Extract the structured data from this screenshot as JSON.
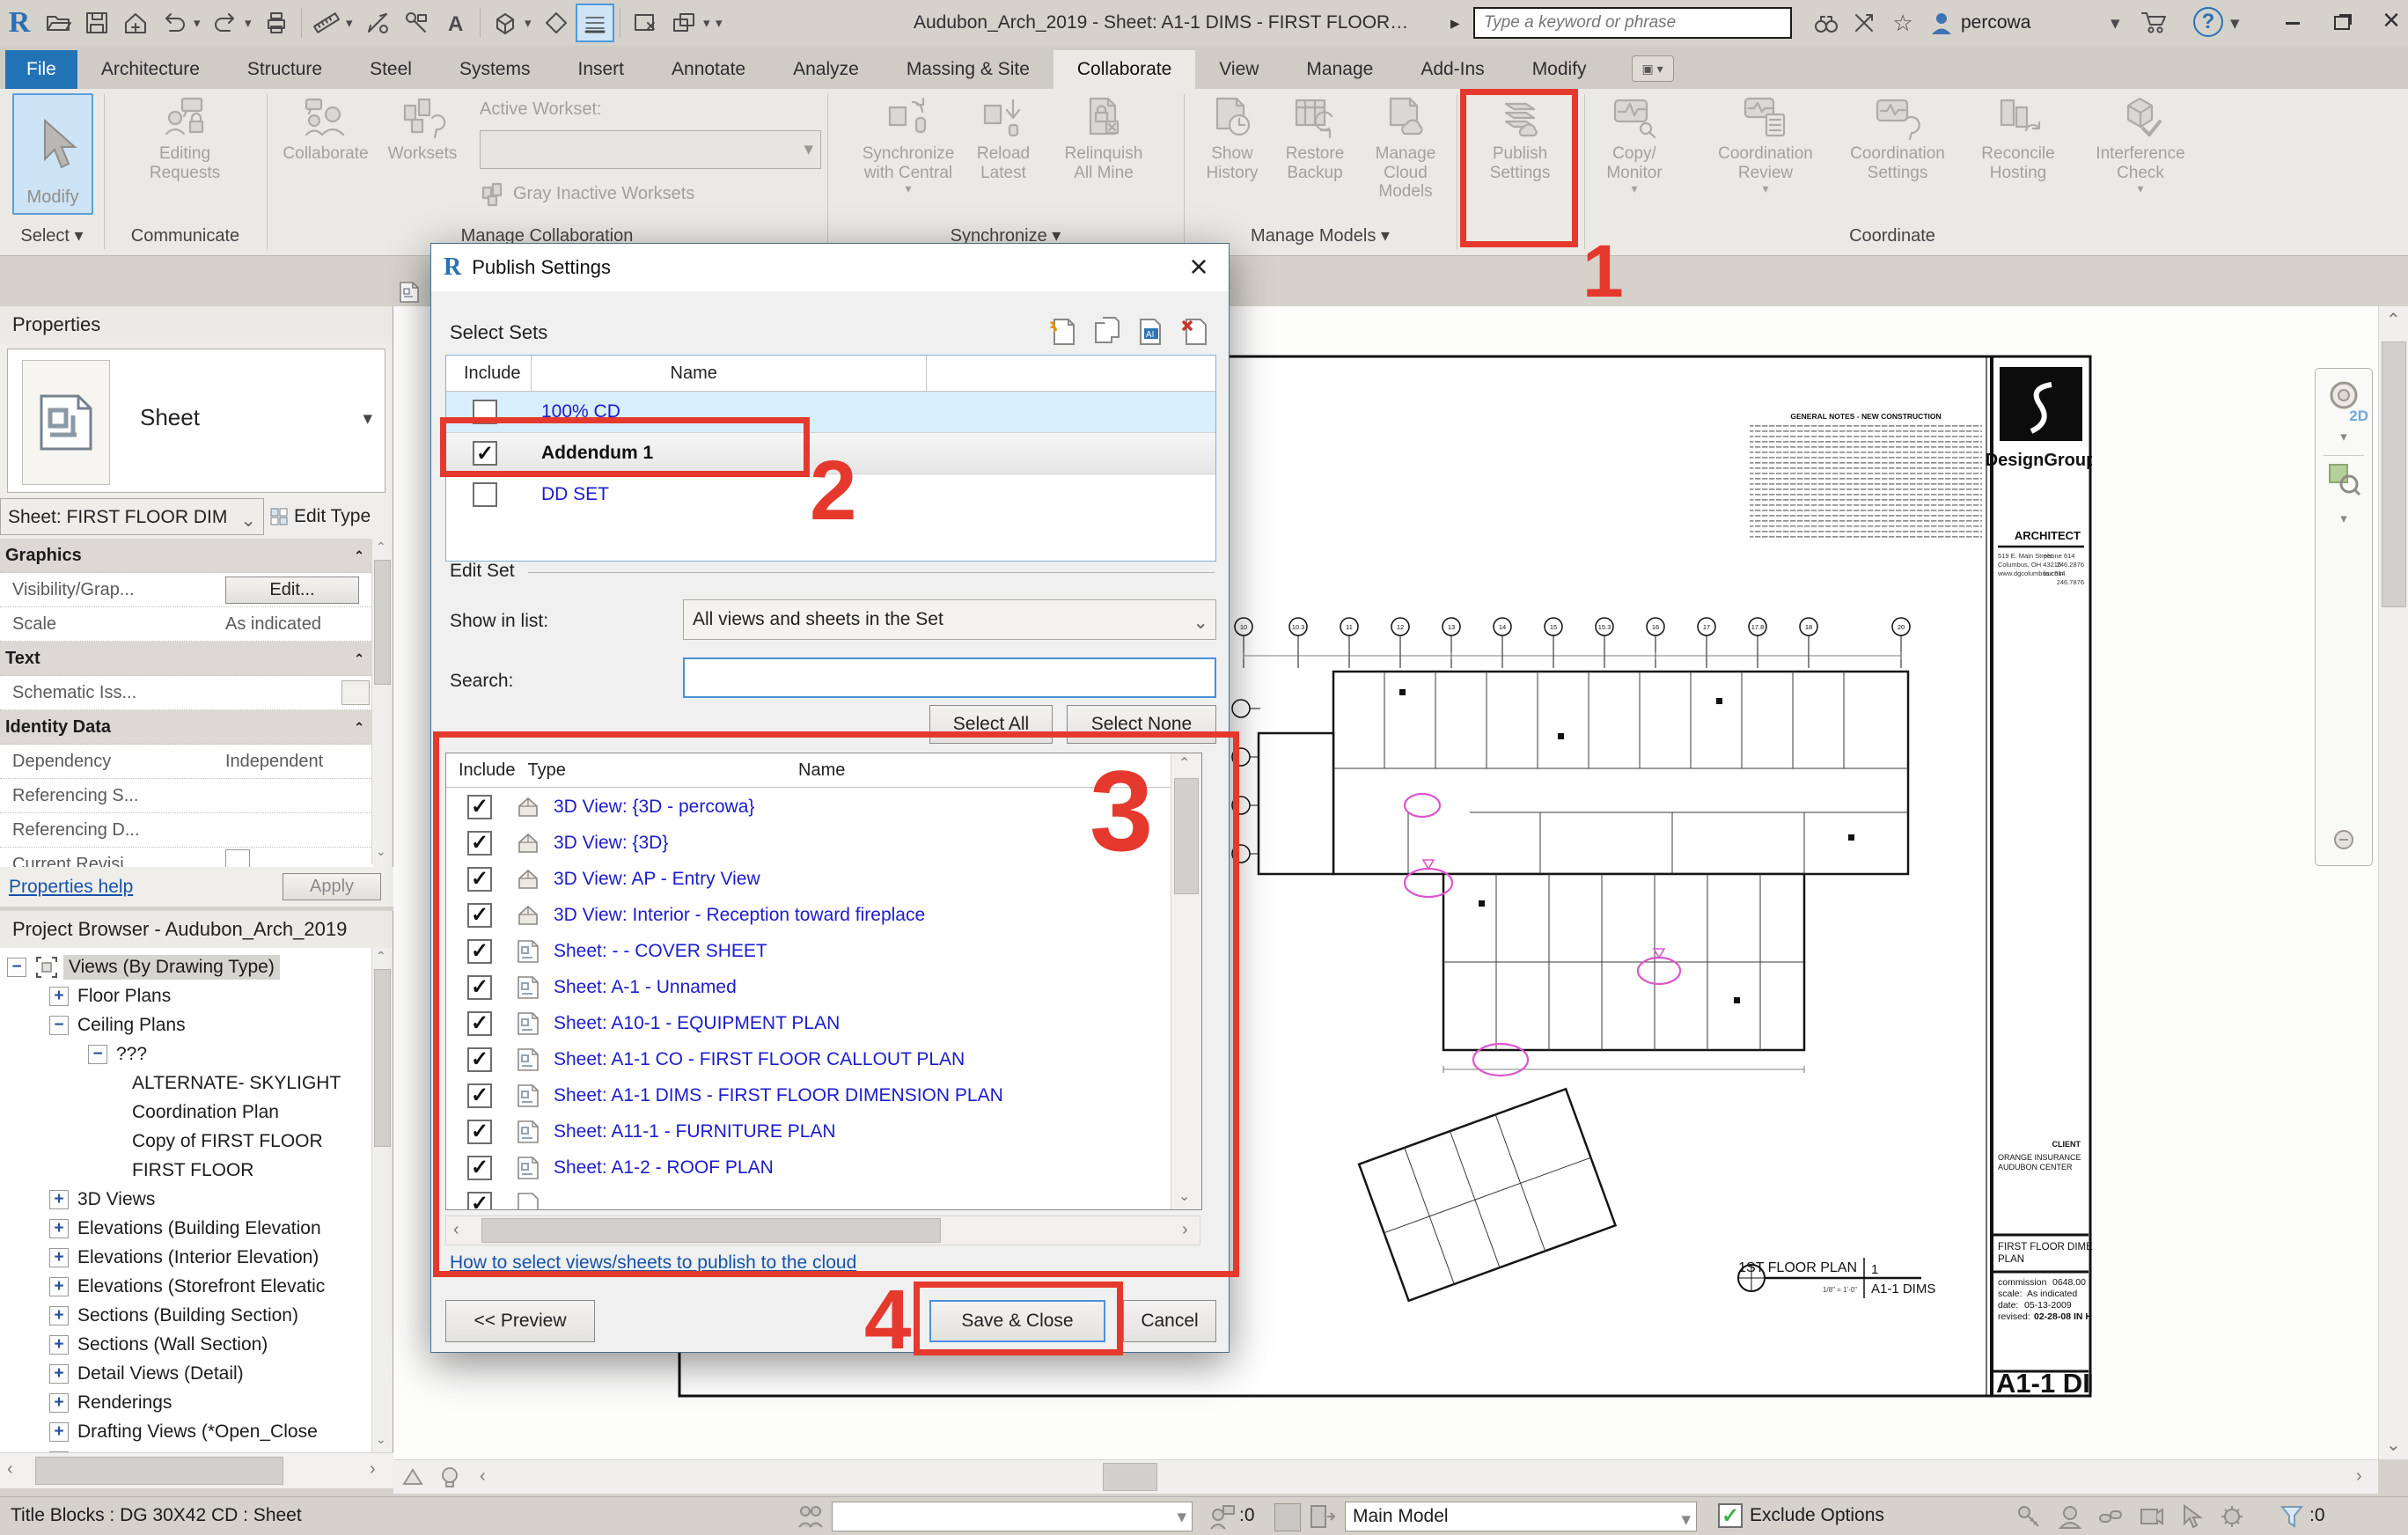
{
  "title_bar": {
    "title": "Audubon_Arch_2019 - Sheet: A1-1 DIMS - FIRST FLOOR DI...",
    "search_placeholder": "Type a keyword or phrase",
    "user": "percowa"
  },
  "icons": {
    "caret_down": "▾",
    "caret_right": "▸",
    "star": "☆",
    "help": "?",
    "close": "×",
    "check": "✓"
  },
  "ribbon": {
    "tabs": [
      "File",
      "Architecture",
      "Structure",
      "Steel",
      "Systems",
      "Insert",
      "Annotate",
      "Analyze",
      "Massing & Site",
      "Collaborate",
      "View",
      "Manage",
      "Add-Ins",
      "Modify"
    ],
    "active_tab": "Collaborate",
    "panels": [
      "Select",
      "Communicate",
      "Manage Collaboration",
      "Synchronize",
      "Manage Models",
      "Coordinate"
    ],
    "buttons": {
      "modify": "Modify",
      "editing_requests": "Editing Requests",
      "collaborate": "Collaborate",
      "worksets": "Worksets",
      "active_workset_label": "Active Workset:",
      "gray_inactive": "Gray Inactive Worksets",
      "sync_central": "Synchronize with Central",
      "reload_latest": "Reload Latest",
      "relinquish": "Relinquish All Mine",
      "show_history": "Show History",
      "restore_backup": "Restore Backup",
      "manage_cloud": "Manage Cloud Models",
      "publish_settings": "Publish Settings",
      "copy_monitor": "Copy/ Monitor",
      "coordination_review": "Coordination Review",
      "coordination_settings": "Coordination Settings",
      "reconcile_hosting": "Reconcile Hosting",
      "interference_check": "Interference Check"
    }
  },
  "dialog": {
    "title": "Publish Settings",
    "select_sets_label": "Select Sets",
    "sets_headers": [
      "Include",
      "Name"
    ],
    "sets": [
      {
        "name": "100% CD",
        "included": false
      },
      {
        "name": "Addendum 1",
        "included": true
      },
      {
        "name": "DD SET",
        "included": false
      }
    ],
    "edit_set_label": "Edit Set",
    "show_in_list_label": "Show in list:",
    "show_in_list_value": "All views and sheets in the Set",
    "search_label": "Search:",
    "select_all": "Select All",
    "select_none": "Select None",
    "list_headers": [
      "Include",
      "Type",
      "Name"
    ],
    "items": [
      {
        "type": "3d",
        "name": "3D View: {3D - percowa}",
        "included": true
      },
      {
        "type": "3d",
        "name": "3D View: {3D}",
        "included": true
      },
      {
        "type": "3d",
        "name": "3D View: AP - Entry View",
        "included": true
      },
      {
        "type": "3d",
        "name": "3D View: Interior - Reception toward fireplace",
        "included": true
      },
      {
        "type": "sheet",
        "name": "Sheet: - - COVER SHEET",
        "included": true
      },
      {
        "type": "sheet",
        "name": "Sheet: A-1 - Unnamed",
        "included": true
      },
      {
        "type": "sheet",
        "name": "Sheet: A10-1 - EQUIPMENT PLAN",
        "included": true
      },
      {
        "type": "sheet",
        "name": "Sheet: A1-1 CO - FIRST FLOOR CALLOUT PLAN",
        "included": true
      },
      {
        "type": "sheet",
        "name": "Sheet: A1-1 DIMS - FIRST FLOOR DIMENSION PLAN",
        "included": true
      },
      {
        "type": "sheet",
        "name": "Sheet: A11-1 - FURNITURE PLAN",
        "included": true
      },
      {
        "type": "sheet",
        "name": "Sheet: A1-2 - ROOF PLAN",
        "included": true
      }
    ],
    "help_link": "How to select views/sheets to publish to the cloud",
    "preview_button": "<< Preview",
    "save_close_button": "Save & Close",
    "cancel_button": "Cancel"
  },
  "properties": {
    "header": "Properties",
    "type_name": "Sheet",
    "instance_selector": "Sheet: FIRST FLOOR DIM",
    "edit_type": "Edit Type",
    "graphics_header": "Graphics",
    "visibility_label": "Visibility/Grap...",
    "visibility_button": "Edit...",
    "scale_label": "Scale",
    "scale_value": "As indicated",
    "text_header": "Text",
    "schematic_label": "Schematic Iss...",
    "identity_header": "Identity Data",
    "dependency_label": "Dependency",
    "dependency_value": "Independent",
    "referencing_sheet": "Referencing S...",
    "referencing_detail": "Referencing D...",
    "current_revision": "Current Revisi...",
    "current_revision2": "Current Revisi",
    "help_link": "Properties help",
    "apply": "Apply"
  },
  "project_browser": {
    "title": "Project Browser - Audubon_Arch_2019",
    "items": [
      {
        "label": "Views (By Drawing Type)",
        "level": 0,
        "exp": "minus",
        "selected": true
      },
      {
        "label": "Floor Plans",
        "level": 1,
        "exp": "plus"
      },
      {
        "label": "Ceiling Plans",
        "level": 1,
        "exp": "minus"
      },
      {
        "label": "???",
        "level": 2,
        "exp": "minus"
      },
      {
        "label": "ALTERNATE- SKYLIGHT",
        "level": 3,
        "exp": "none"
      },
      {
        "label": "Coordination Plan",
        "level": 3,
        "exp": "none"
      },
      {
        "label": "Copy of FIRST FLOOR",
        "level": 3,
        "exp": "none"
      },
      {
        "label": "FIRST FLOOR",
        "level": 3,
        "exp": "none"
      },
      {
        "label": "3D Views",
        "level": 1,
        "exp": "plus"
      },
      {
        "label": "Elevations (Building Elevation",
        "level": 1,
        "exp": "plus"
      },
      {
        "label": "Elevations (Interior Elevation)",
        "level": 1,
        "exp": "plus"
      },
      {
        "label": "Elevations (Storefront Elevatic",
        "level": 1,
        "exp": "plus"
      },
      {
        "label": "Sections (Building Section)",
        "level": 1,
        "exp": "plus"
      },
      {
        "label": "Sections (Wall Section)",
        "level": 1,
        "exp": "plus"
      },
      {
        "label": "Detail Views (Detail)",
        "level": 1,
        "exp": "plus"
      },
      {
        "label": "Renderings",
        "level": 1,
        "exp": "plus"
      },
      {
        "label": "Drafting Views (*Open_Close",
        "level": 1,
        "exp": "plus"
      },
      {
        "label": "Drafting Views (Detail)",
        "level": 1,
        "exp": "plus"
      }
    ]
  },
  "status_bar": {
    "left_text": "Title Blocks : DG 30X42 CD : Sheet",
    "requests_count": ":0",
    "active_model": "Main Model",
    "exclude_options": "Exclude Options",
    "filter_count": ":0"
  },
  "nav_bar": {
    "wheel_label": "2D"
  },
  "annotations": {
    "steps": [
      "1",
      "2",
      "3",
      "4"
    ],
    "color": "#e5392e"
  },
  "sheet": {
    "firm": "DesignGroup",
    "architect_label": "ARCHITECT",
    "address_lines": [
      "519 E. Main Street",
      "Columbus, OH 43215",
      "www.dgcolumbus.com"
    ],
    "contact_lines": [
      "phone 614",
      "246.2876",
      "fax 614",
      "246.7876"
    ],
    "client_label": "CLIENT",
    "client_lines": [
      "ORANGE INSURANCE",
      "AUDUBON CENTER"
    ],
    "title_lines": [
      "FIRST FLOOR DIMENSION",
      "PLAN"
    ],
    "commission_label": "commission",
    "commission_value": "0648.00",
    "scale_label": "scale:",
    "scale_value": "As indicated",
    "date_label": "date:",
    "date_value": "05-13-2009",
    "revised_label": "revised:",
    "revised_value": "02-28-08  IN HOUSE",
    "sheet_number": "A1-1 DIMS",
    "view_title": "1ST FLOOR PLAN",
    "view_number": "1",
    "view_sheet_ref": "A1-1 DIMS",
    "view_scale": "1/8\" = 1'-0\"",
    "notes_title": "GENERAL NOTES - NEW CONSTRUCTION",
    "grid_bubbles": [
      "10",
      "10.3",
      "11",
      "12",
      "13",
      "14",
      "15",
      "15.3",
      "16",
      "17",
      "17.8",
      "18",
      "20"
    ]
  }
}
